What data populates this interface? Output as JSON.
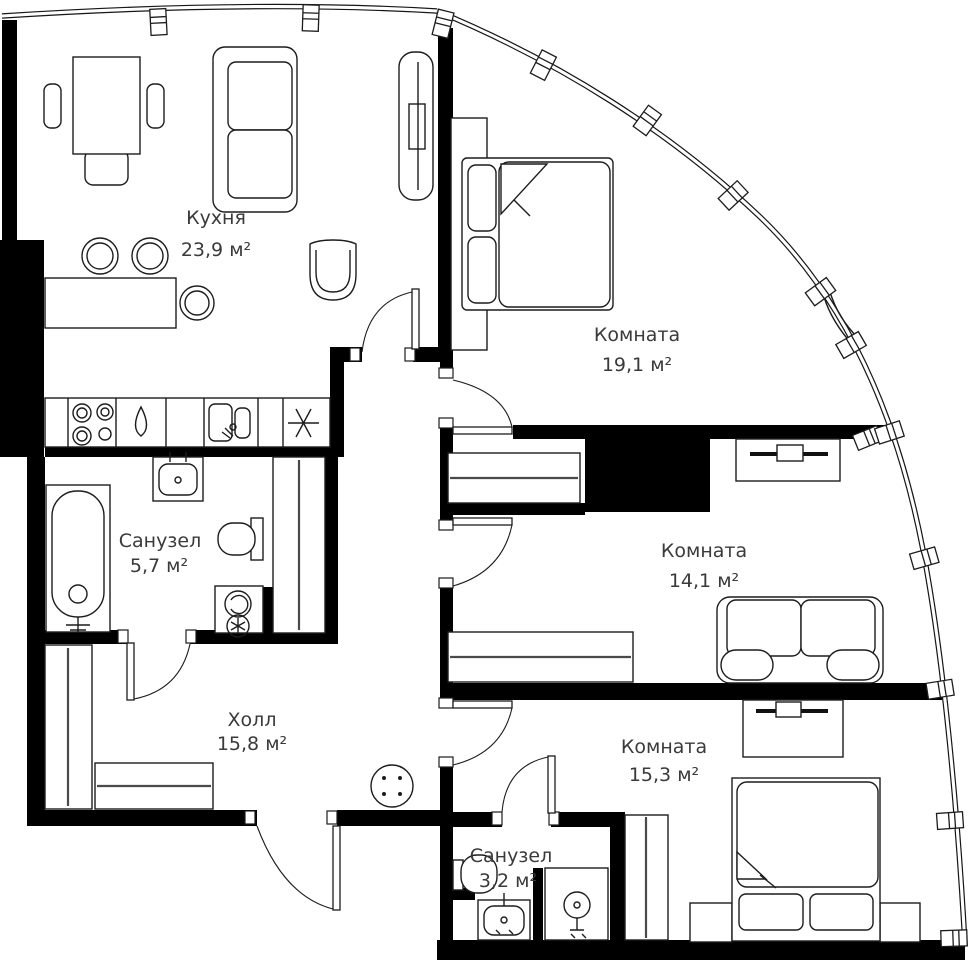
{
  "plan": {
    "type": "apartment-floor-plan",
    "colors": {
      "background": "#ffffff",
      "walls": "#000000",
      "furniture_line": "#1c1c1c",
      "label_text": "#3a3a3a"
    },
    "rooms": [
      {
        "id": "kitchen",
        "name": "Кухня",
        "area": "23,9 м²"
      },
      {
        "id": "bedroom-1",
        "name": "Комната",
        "area": "19,1 м²"
      },
      {
        "id": "bedroom-2",
        "name": "Комната",
        "area": "14,1 м²"
      },
      {
        "id": "bedroom-3",
        "name": "Комната",
        "area": "15,3 м²"
      },
      {
        "id": "bathroom-1",
        "name": "Санузел",
        "area": "5,7 м²"
      },
      {
        "id": "bathroom-2",
        "name": "Санузел",
        "area": "3,2 м²"
      },
      {
        "id": "hall",
        "name": "Холл",
        "area": "15,8 м²"
      }
    ]
  }
}
